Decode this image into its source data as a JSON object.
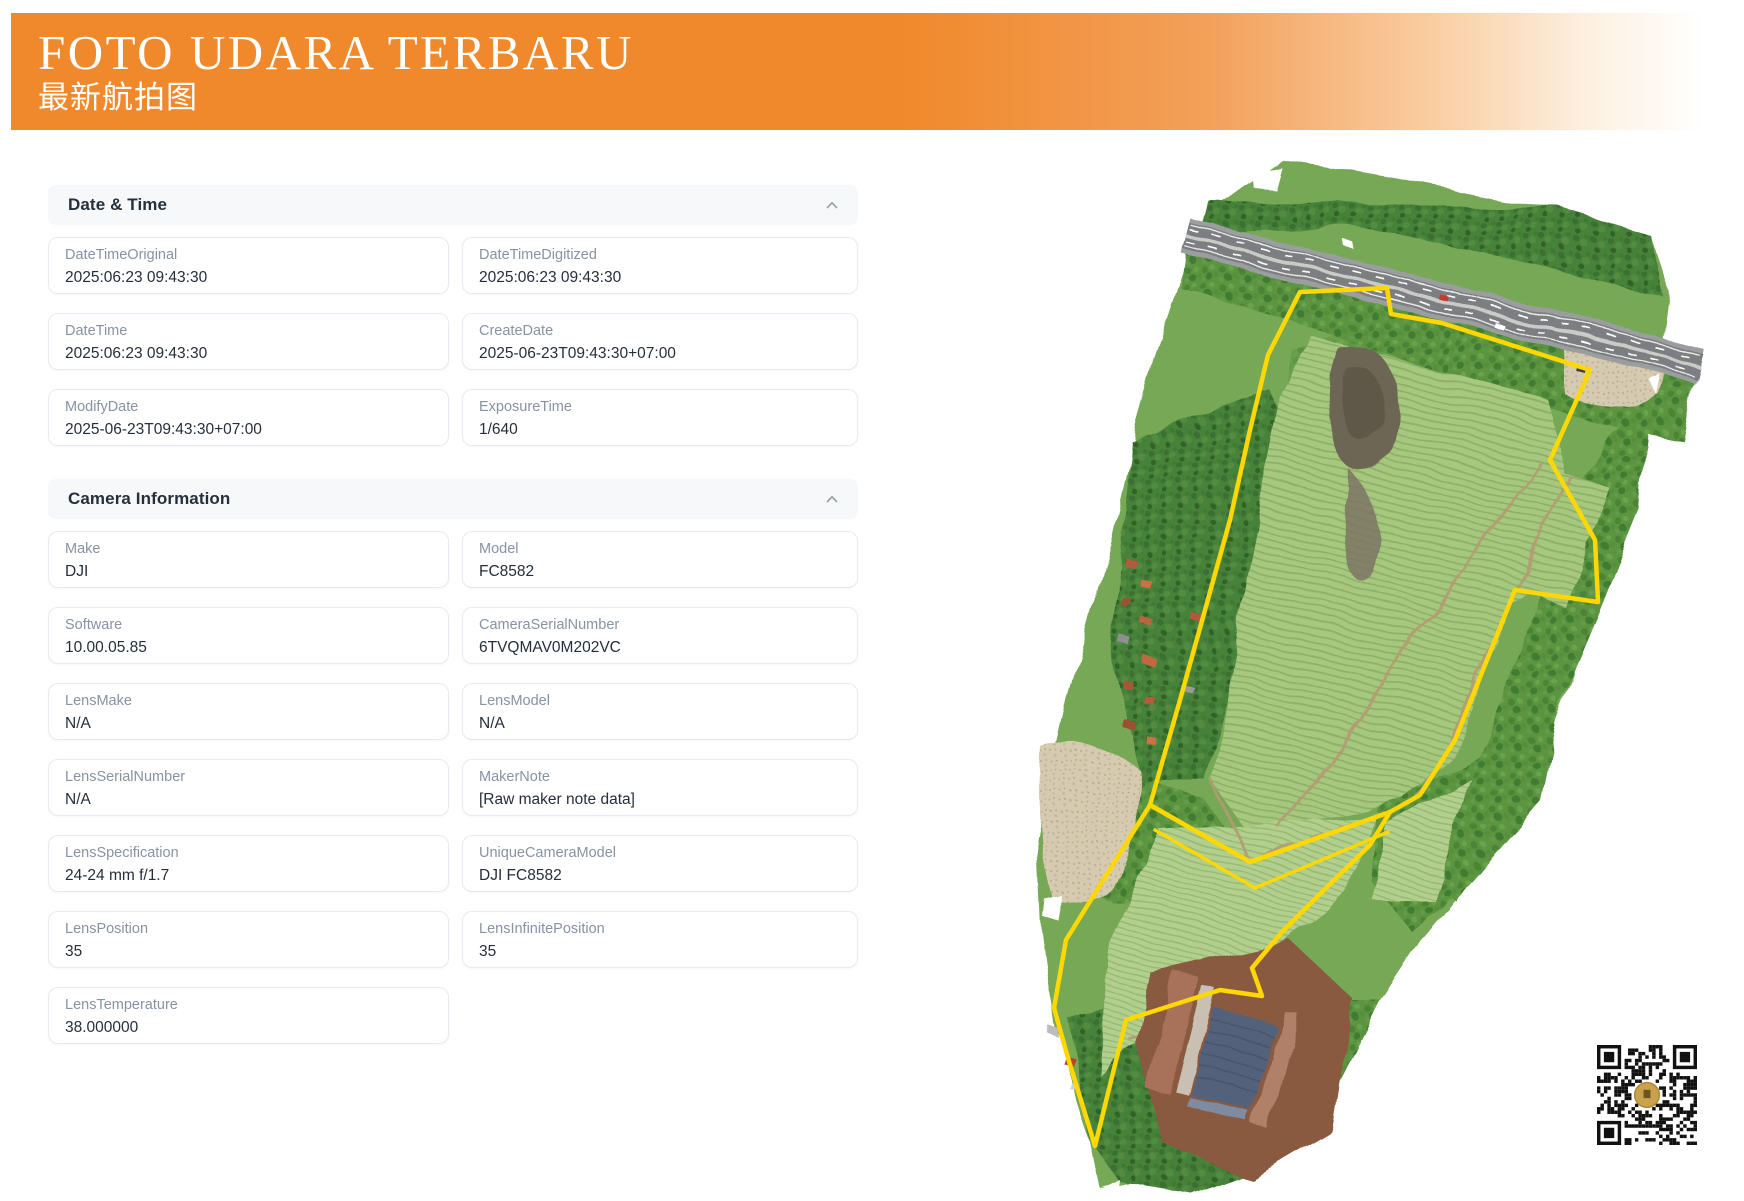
{
  "banner": {
    "title": "FOTO UDARA TERBARU",
    "subtitle": "最新航拍图",
    "accent_color": "#F0892B"
  },
  "sections": [
    {
      "title": "Date & Time",
      "collapse_icon": "chevron-up",
      "fields": [
        {
          "label": "DateTimeOriginal",
          "value": "2025:06:23 09:43:30"
        },
        {
          "label": "DateTimeDigitized",
          "value": "2025:06:23 09:43:30"
        },
        {
          "label": "DateTime",
          "value": "2025:06:23 09:43:30"
        },
        {
          "label": "CreateDate",
          "value": "2025-06-23T09:43:30+07:00"
        },
        {
          "label": "ModifyDate",
          "value": "2025-06-23T09:43:30+07:00"
        },
        {
          "label": "ExposureTime",
          "value": "1/640"
        }
      ]
    },
    {
      "title": "Camera Information",
      "collapse_icon": "chevron-up",
      "fields": [
        {
          "label": "Make",
          "value": "DJI"
        },
        {
          "label": "Model",
          "value": "FC8582"
        },
        {
          "label": "Software",
          "value": "10.00.05.85"
        },
        {
          "label": "CameraSerialNumber",
          "value": "6TVQMAV0M202VC"
        },
        {
          "label": "LensMake",
          "value": "N/A"
        },
        {
          "label": "LensModel",
          "value": "N/A"
        },
        {
          "label": "LensSerialNumber",
          "value": "N/A"
        },
        {
          "label": "MakerNote",
          "value": "[Raw maker note data]"
        },
        {
          "label": "LensSpecification",
          "value": "24-24 mm f/1.7"
        },
        {
          "label": "UniqueCameraModel",
          "value": "DJI FC8582"
        },
        {
          "label": "LensPosition",
          "value": "35"
        },
        {
          "label": "LensInfinitePosition",
          "value": "35"
        },
        {
          "label": "LensTemperature",
          "value": "38.000000"
        }
      ]
    }
  ],
  "map": {
    "description": "drone-orthomosaic-of-farm-parcel",
    "boundary_color": "#FFD702",
    "icon": "aerial-map"
  },
  "qr": {
    "icon": "qr-code",
    "center_logo_color": "#C9A24B"
  }
}
